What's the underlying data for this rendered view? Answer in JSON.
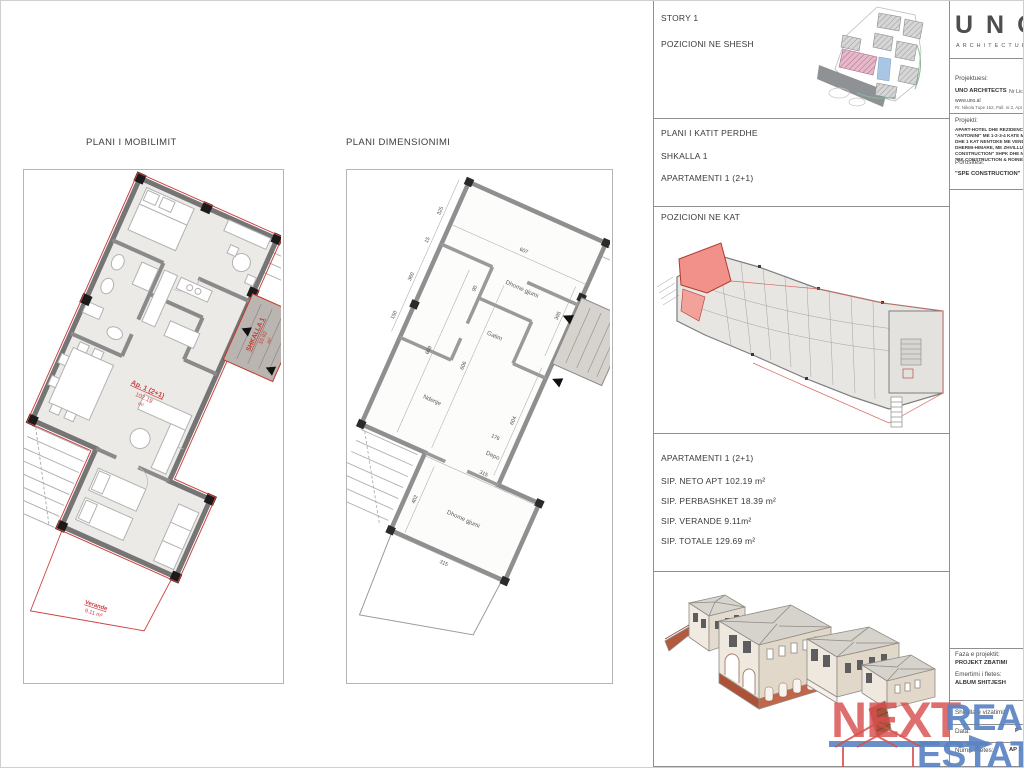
{
  "plans": {
    "mobilimit": {
      "title": "PLANI I MOBILIMIT",
      "apt_label": "Ap. 1 (2+1)",
      "apt_area": "102.19",
      "apt_unit": "m²",
      "stair_label": "SHKALLA 1",
      "stair_area": "10.92",
      "stair_unit": "m²",
      "veranda_label": "Verande",
      "veranda_area": "9.11 m²"
    },
    "dimensionimi": {
      "title": "PLANI DIMENSIONIMI",
      "rooms": [
        "Dhome gjumi",
        "Gatim",
        "Ndenje",
        "Depo",
        "Dhome gjumi"
      ],
      "dims": [
        "607",
        "395",
        "325",
        "15",
        "360",
        "150",
        "90",
        "609",
        "606",
        "604",
        "176",
        "315",
        "402",
        "315"
      ]
    }
  },
  "sidebar": {
    "story_title": "STORY 1",
    "story_sub": "POZICIONI NE SHESH",
    "kat_line1": "PLANI I KATIT PERDHE",
    "kat_line2": "SHKALLA 1",
    "kat_line3": "APARTAMENTI 1 (2+1)",
    "poz_kat_title": "POZICIONI NE KAT",
    "area_title": "APARTAMENTI 1 (2+1)",
    "area_rows": [
      "SIP. NETO APT  102.19 m²",
      "SIP. PERBASHKET 18.39 m²",
      "SIP. VERANDE 9.11m²",
      "SIP. TOTALE  129.69 m²"
    ]
  },
  "titleblock": {
    "logo_text": "UNO",
    "logo_sub": "ARCHITECTURE",
    "projektuesi_label": "Projektuesi:",
    "projektuesi_name": "UNO ARCHITECTS",
    "projektuesi_lic": "Nr Lic",
    "projektuesi_web": "www.uno.al",
    "projektuesi_addr": "Rr. Nikola Tupe 152, Pall. nr.2, Apt 1",
    "projekti_label": "Projekti:",
    "projekti_lines": [
      "APART-HOTEL DHE REZIDENCE",
      "\"ANTONINI\" ME 1-2-3-4 KATE MB",
      "DHE 1 KAT NENTOKE ME VENDND",
      "DHERMI-HIMARE, ME ZHVILLUES",
      "CONSTRUCTION\" SHPK DHE NDER",
      "\"RK CONSTRUCTION & ROINERG"
    ],
    "porositesi_label": "Porositesi:",
    "porositesi_name": "\"SPE CONSTRUCTION\"",
    "faza_label": "Faza e projektit:",
    "faza_value": "PROJEKT ZBATIMI",
    "emertimi_label": "Emertimi i fletes:",
    "emertimi_value": "ALBUM SHITJESH",
    "shkalla_label": "Shkalla e vizatimit:",
    "data_label": "Data:",
    "data_value": "P",
    "numri_label": "Numri i fletes:",
    "numri_value": "AP 1"
  },
  "watermark": {
    "word1": "NEXT",
    "word2": "REAL",
    "word3": "ESTATE"
  }
}
